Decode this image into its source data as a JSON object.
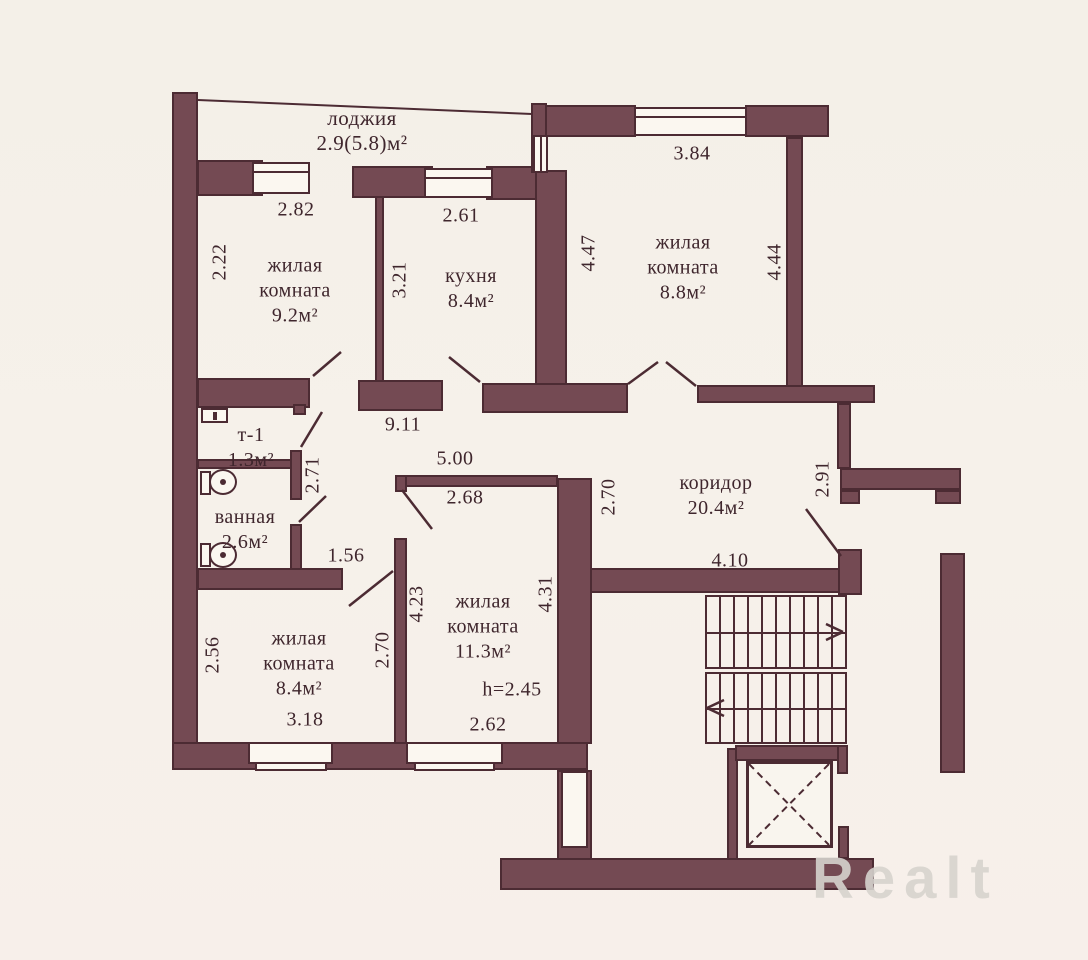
{
  "watermark": "Realt",
  "balcony": {
    "name": "лоджия",
    "area": "2.9(5.8)м²"
  },
  "rooms": {
    "living1": {
      "l1": "жилая",
      "l2": "комната",
      "area": "9.2м²"
    },
    "kitchen": {
      "l1": "кухня",
      "area": "8.4м²"
    },
    "living2": {
      "l1": "жилая",
      "l2": "комната",
      "area": "8.8м²"
    },
    "corridor": {
      "l1": "коридор",
      "area": "20.4м²"
    },
    "wc": {
      "l1": "т-1",
      "area": "1.3м²"
    },
    "bath": {
      "l1": "ванная",
      "area": "2.6м²"
    },
    "living3": {
      "l1": "жилая",
      "l2": "комната",
      "area": "8.4м²"
    },
    "living4": {
      "l1": "жилая",
      "l2": "комната",
      "area": "11.3м²",
      "ceiling": "h=2.45"
    }
  },
  "dims": {
    "top_w282": "2.82",
    "top_v222": "2.22",
    "kit_w261": "2.61",
    "kit_v321": "3.21",
    "tr_w384": "3.84",
    "tr_v447": "4.47",
    "tr_v444": "4.44",
    "mid_w911": "9.11",
    "mid_w500": "5.00",
    "mid_w268": "2.68",
    "cor_v270": "2.70",
    "cor_v291": "2.91",
    "cor_w410": "4.10",
    "wc_v271": "2.71",
    "bath_w156": "1.56",
    "bl_v256": "2.56",
    "bl_v270": "2.70",
    "bl_w318": "3.18",
    "bm_v423": "4.23",
    "bm_v431": "4.31",
    "bm_w262": "2.62"
  },
  "colors": {
    "wall": "#744a53",
    "outline": "#4c2b33",
    "background": "#f5f0e9",
    "text": "#3f262d"
  }
}
